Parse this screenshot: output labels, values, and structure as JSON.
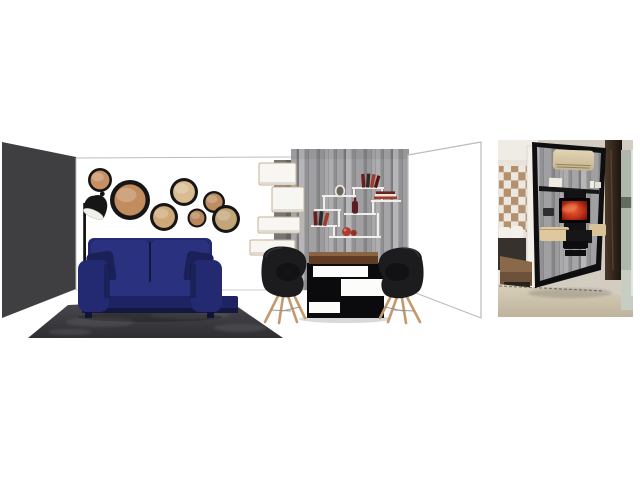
{
  "page": {
    "background": "#ffffff"
  },
  "scene": {
    "kind": "interior-design-moodboard",
    "room": {
      "left_wall_color": "#3f3e41",
      "back_wall_color": "#ffffff",
      "outline_color": "#bcbcbc",
      "floor_line_color": "#cccccc"
    },
    "mirror_frame": "#161616",
    "mirrors": [
      {
        "cx": 100,
        "cy": 180,
        "r": 12,
        "glass": "#c69064"
      },
      {
        "cx": 130,
        "cy": 200,
        "r": 20,
        "glass": "#c28c5e"
      },
      {
        "cx": 184,
        "cy": 192,
        "r": 14,
        "glass": "#d9bc92"
      },
      {
        "cx": 164,
        "cy": 217,
        "r": 14,
        "glass": "#cfa87a"
      },
      {
        "cx": 197,
        "cy": 218,
        "r": 9.5,
        "glass": "#b8885c"
      },
      {
        "cx": 214,
        "cy": 202,
        "r": 11,
        "glass": "#bd8d60"
      },
      {
        "cx": 226,
        "cy": 219,
        "r": 14,
        "glass": "#c2a578"
      }
    ],
    "lamp": {
      "body": "#161616",
      "shade_inner": "#f2f0ea"
    },
    "sofa": {
      "main": "#232a72",
      "cushion": "#2a327f",
      "pillow": "#1b2158",
      "base": "#1d2363",
      "shadow": "#14183f",
      "leg": "#101338"
    },
    "rug": {
      "light": "#4c4c50",
      "dark": "#2f2f33",
      "streak": "#66666b"
    },
    "shelf_tower": {
      "box": "#f7f6f2",
      "border": "#c7b191",
      "spine": "#767679",
      "spine_shadow": "#56565a"
    },
    "accent_wall": {
      "base": "#9a9a9c",
      "planks": [
        "#aeaeb0",
        "#8f8f91",
        "#a5a5a7",
        "#7e7e81",
        "#b6b6b8",
        "#929294",
        "#a0a0a3",
        "#868689",
        "#9b9b9d",
        "#a9a9ab"
      ]
    },
    "wall_shelf": {
      "line": "#f0efec",
      "book_red": "#a33a2c",
      "book_dark": "#551312",
      "book_maroon": "#6e1d1c",
      "book_black": "#2e2a28",
      "stack_red": "#a8382e",
      "stack_white": "#ece6da",
      "stack_dark": "#6e2220",
      "bottle": "#5c1e22",
      "frame_ring": "#e8e5df",
      "frame_center": "#6b665f",
      "sphere_big": "#b03a30",
      "sphere_small": "#93301f"
    },
    "table": {
      "top_light": "#8a6442",
      "top_dark": "#5f3d24",
      "base": "#0b0b0d",
      "band": "#fcfcfa"
    },
    "chair": {
      "shell": "#1c1c1e",
      "shell_hi": "#3a3a3c",
      "leg": "#c49a6d",
      "strut": "#8e8e90"
    }
  },
  "photo": {
    "kind": "reference-photo-media-wall",
    "wall": "#d3ccc0",
    "white_wall": "#efece6",
    "floor_light": "#d9d0ba",
    "floor_dark": "#beb49e",
    "baseboard": "#6e6557",
    "bedroom": {
      "checker_dark": "#b5906c",
      "checker_light": "#ece7e0",
      "door_frame": "#f2efe9",
      "pillow": "#f3f0ea",
      "bed": "#36312c",
      "wood": "#8a684a",
      "wood_dark": "#6d513a",
      "base": "#27221f"
    },
    "media_wall": {
      "frame": "#0e0e10",
      "shelf": "#161616",
      "panel_black": "#121214",
      "tv_bezel": "#050506",
      "tv_center": "#e85f35",
      "tv_mid": "#c03018",
      "tv_edge": "#5e0d08",
      "ac_light": "#e2d5b4",
      "ac_dark": "#c6b48e",
      "ac_vent": "#8f815f",
      "cabinet": "#dfc79e",
      "cabinet2": "#d9c198",
      "box_black": "#0d0d0f",
      "white_deco": "#f0ece2"
    },
    "right_side": {
      "pillar_light": "#4a3928",
      "pillar_dark": "#1b140e",
      "glass": "#aeb7ac",
      "glass_band": "#626b60",
      "glass_low": "#c6cdc2",
      "frame_white": "#e5e5e1"
    }
  }
}
